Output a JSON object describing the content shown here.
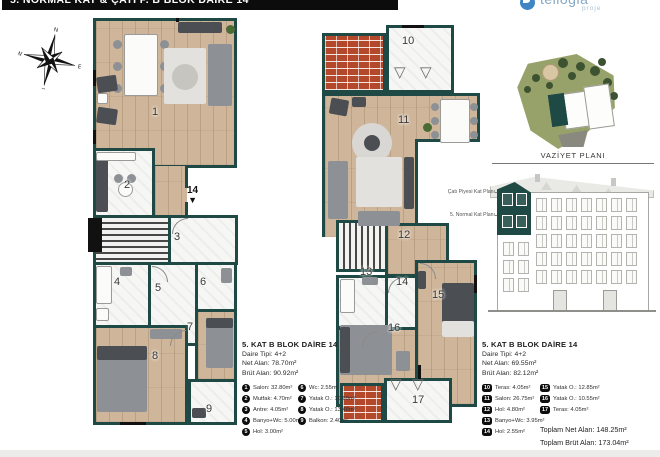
{
  "header": {
    "title": "5. NORMAL KAT & ÇATI P. B BLOK DAİRE 14"
  },
  "logo": {
    "name": "tellogia",
    "subtitle": "proje",
    "accent": "#3f86c2"
  },
  "compass": {
    "north": "N",
    "east": "E",
    "south": "S",
    "west": "W"
  },
  "site_plan": {
    "label": "VAZİYET PLANI"
  },
  "elevation": {
    "labels": [
      "Çatı Piyesi Kat Planı",
      "5. Normal Kat Planı"
    ]
  },
  "colors": {
    "wall": "#1e4944",
    "wood_floor": "#cfb69a",
    "brick": "#b3482a",
    "highlight": "#1e4944"
  },
  "plan_a": {
    "legend_title": "5. KAT B BLOK DAİRE 14",
    "type_line": "Daire Tipi: 4+2",
    "net_line": "Net Alan: 78.70m²",
    "brut_line": "Brüt Alan: 90.92m²",
    "entry_marker": "14",
    "rooms": [
      {
        "num": "1",
        "name": "Salon",
        "area": "32.80m²",
        "px": 72,
        "py": 88
      },
      {
        "num": "2",
        "name": "Mutfak",
        "area": "4.70m²",
        "px": 44,
        "py": 161
      },
      {
        "num": "3",
        "name": "Antre",
        "area": "4.05m²",
        "px": 94,
        "py": 213
      },
      {
        "num": "4",
        "name": "Banyo+Wc",
        "area": "5.00m²",
        "px": 34,
        "py": 258
      },
      {
        "num": "5",
        "name": "Hol",
        "area": "3.00m²",
        "px": 75,
        "py": 264
      },
      {
        "num": "6",
        "name": "Wc",
        "area": "2.55m²",
        "px": 120,
        "py": 258
      },
      {
        "num": "7",
        "name": "Yatak O.",
        "area": "10.69m²",
        "px": 107,
        "py": 303
      },
      {
        "num": "8",
        "name": "Yatak O.",
        "area": "13.48m²",
        "px": 72,
        "py": 332
      },
      {
        "num": "9",
        "name": "Balkon",
        "area": "2.40m²",
        "px": 126,
        "py": 385
      }
    ]
  },
  "plan_b": {
    "legend_title": "5. KAT B BLOK DAİRE 14",
    "type_line": "Daire Tipi: 4+2",
    "net_line": "Net Alan: 69.55m²",
    "brut_line": "Brüt Alan: 82.12m²",
    "rooms": [
      {
        "num": "10",
        "name": "Teras",
        "area": "4.05m²",
        "px": 80,
        "py": 10
      },
      {
        "num": "11",
        "name": "Salon",
        "area": "26.75m²",
        "px": 76,
        "py": 89
      },
      {
        "num": "12",
        "name": "Hol",
        "area": "4.80m²",
        "px": 76,
        "py": 204
      },
      {
        "num": "13",
        "name": "Banyo+Wc",
        "area": "3.95m²",
        "px": 38,
        "py": 241
      },
      {
        "num": "14",
        "name": "Hol",
        "area": "2.55m²",
        "px": 74,
        "py": 251
      },
      {
        "num": "15",
        "name": "Yatak O.",
        "area": "12.85m²",
        "px": 110,
        "py": 264
      },
      {
        "num": "16",
        "name": "Yatak O.",
        "area": "10.55m²",
        "px": 66,
        "py": 297
      },
      {
        "num": "17",
        "name": "Teras",
        "area": "4.05m²",
        "px": 90,
        "py": 369
      }
    ],
    "totals": [
      "Toplam Net Alan: 148.25m²",
      "Toplam Brüt Alan: 173.04m²"
    ]
  }
}
